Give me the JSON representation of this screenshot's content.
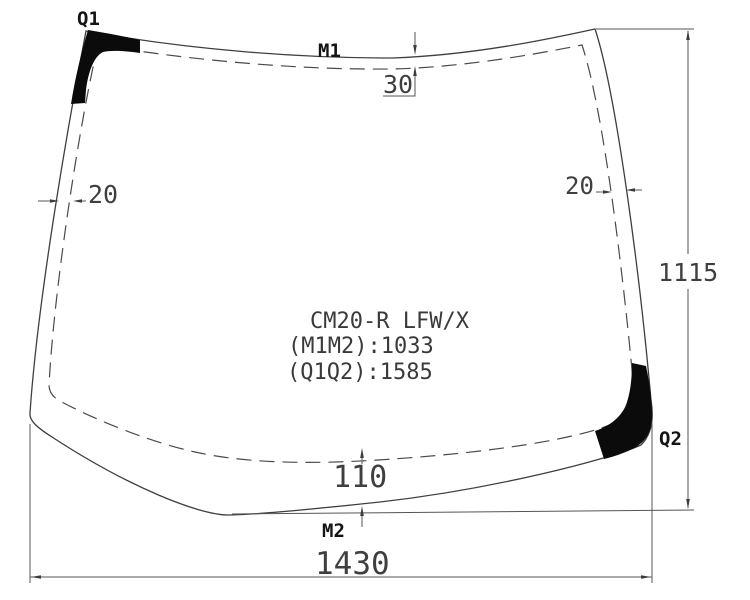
{
  "diagram": {
    "title_block": {
      "part_code": "CM20-R LFW/X",
      "m1m2_line": "(M1M2):1033",
      "q1q2_line": "(Q1Q2):1585"
    },
    "points": {
      "q1": "Q1",
      "m1": "M1",
      "q2": "Q2",
      "m2": "M2"
    },
    "dimensions": {
      "top_band": "30",
      "left_band": "20",
      "right_band": "20",
      "bottom_band": "110",
      "height": "1115",
      "width": "1430"
    },
    "colors": {
      "line": "#3f3f3f",
      "dash": "#4a4a4a",
      "dimension": "#555555",
      "label": "#141414",
      "patch": "#0b0b0b",
      "background": "#ffffff"
    }
  }
}
